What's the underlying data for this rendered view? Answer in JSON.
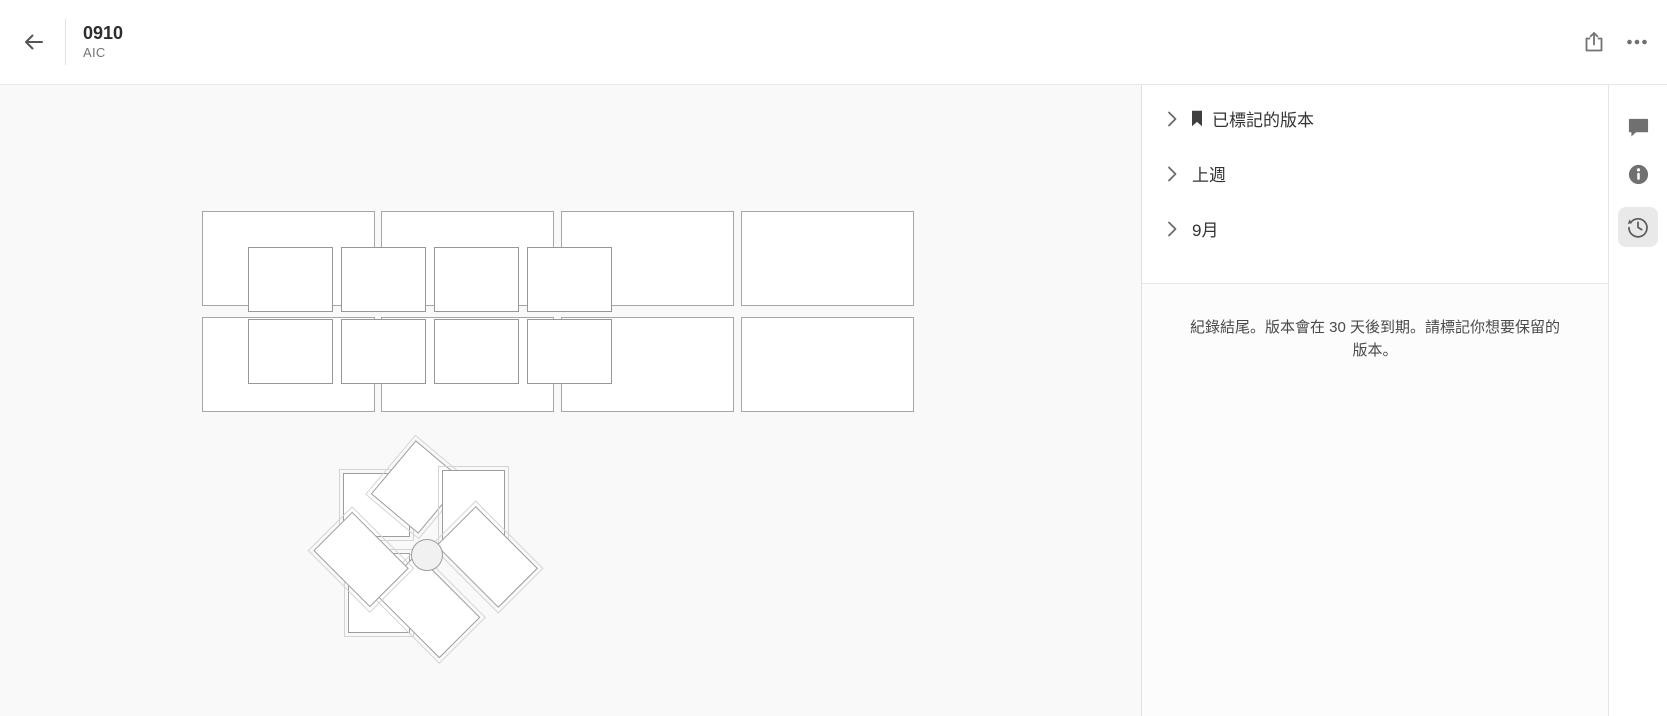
{
  "header": {
    "title": "0910",
    "subtitle": "AIC"
  },
  "panel": {
    "sections": [
      {
        "id": "marked-versions",
        "label": "已標記的版本",
        "bookmarked": true
      },
      {
        "id": "last-week",
        "label": "上週",
        "bookmarked": false
      },
      {
        "id": "september",
        "label": "9月",
        "bookmarked": false
      }
    ],
    "notice": "紀錄結尾。版本會在 30 天後到期。請標記你想要保留的版本。"
  },
  "toolbar": {
    "active_tool": "history",
    "buttons": [
      {
        "id": "comments",
        "icon": "comment-icon"
      },
      {
        "id": "info",
        "icon": "info-icon"
      },
      {
        "id": "history",
        "icon": "history-icon"
      }
    ]
  },
  "icons": {
    "back": "arrow-left-icon",
    "share": "share-icon",
    "more": "ellipsis-icon",
    "expand": "chevron-right-icon",
    "bookmark": "bookmark-icon"
  },
  "colors": {
    "canvas_bg": "#f9f9f9",
    "panel_bg": "#ffffff",
    "notice_bg": "#fcfcfc",
    "divider": "#e8e8e8",
    "artboard_border": "#a6a6a6",
    "inner_border": "#979797",
    "blade_border": "#9d9d9d",
    "icon": "#707070",
    "text_primary": "#2d2d2d",
    "text_secondary": "#767676",
    "label": "#333333",
    "notice_text": "#4a4a4a",
    "selected_tool_bg": "#e9e9e9"
  },
  "canvas": {
    "grid": {
      "cols_x": [
        202,
        381,
        561,
        741
      ],
      "rows_y": [
        126,
        232
      ],
      "cell_w": 173,
      "cell_h": 95,
      "inner_cols_x": [
        248,
        341,
        434,
        527
      ],
      "inner_rows_y": [
        162,
        234
      ],
      "inner_w": 85,
      "inner_h": 65
    },
    "pinwheel": {
      "cx": 427,
      "cy": 470,
      "r": 16,
      "blades": [
        {
          "x": 343,
          "y": 388,
          "w": 67,
          "h": 64,
          "rot": 0
        },
        {
          "x": 386,
          "y": 367,
          "w": 62,
          "h": 70,
          "rot": 40
        },
        {
          "x": 442,
          "y": 385,
          "w": 63,
          "h": 75,
          "rot": 0
        },
        {
          "x": 443,
          "y": 444,
          "w": 88,
          "h": 56,
          "rot": 45
        },
        {
          "x": 348,
          "y": 468,
          "w": 62,
          "h": 80,
          "rot": 0
        },
        {
          "x": 383,
          "y": 492,
          "w": 90,
          "h": 58,
          "rot": 45
        },
        {
          "x": 321,
          "y": 447,
          "w": 80,
          "h": 55,
          "rot": 45
        }
      ]
    }
  }
}
